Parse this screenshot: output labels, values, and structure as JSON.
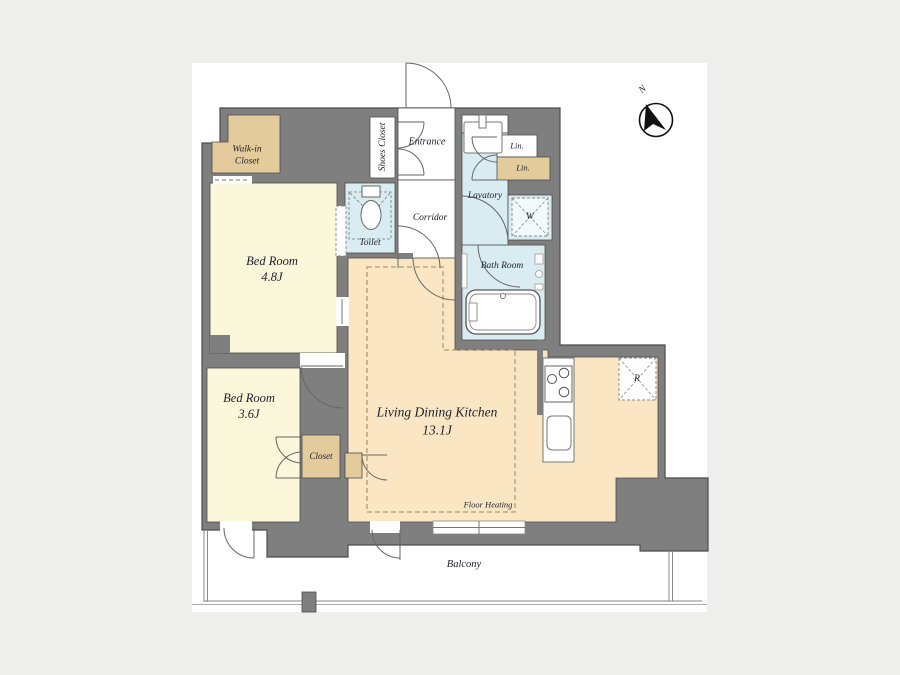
{
  "plan": {
    "type": "apartment-floor-plan",
    "layout_label": "2LDK"
  },
  "rooms": {
    "bedroom1": {
      "name": "Bed Room",
      "size": "4.8J"
    },
    "bedroom2": {
      "name": "Bed Room",
      "size": "3.6J"
    },
    "ldk": {
      "name": "Living Dining Kitchen",
      "size": "13.1J"
    },
    "walk_in_closet": {
      "line1": "Walk-in",
      "line2": "Closet"
    },
    "shoes_closet": {
      "name": "Shoes Closet"
    },
    "entrance": {
      "name": "Entrance"
    },
    "corridor": {
      "name": "Corridor"
    },
    "toilet": {
      "name": "Toilet"
    },
    "lavatory": {
      "name": "Lavatory"
    },
    "bath_room": {
      "name": "Bath Room"
    },
    "closet": {
      "name": "Closet"
    },
    "linen_upper": {
      "name": "Lin."
    },
    "linen_lower": {
      "name": "Lin."
    },
    "washer": {
      "symbol": "W"
    },
    "refrigerator": {
      "symbol": "R"
    },
    "floor_heating": {
      "name": "Floor Heating"
    },
    "balcony": {
      "name": "Balcony"
    }
  },
  "compass": {
    "north": "N"
  },
  "colors": {
    "background": "#eeeeec",
    "page": "#ffffff",
    "wall": "#7f7f7f",
    "wall_line": "#4c4c4c",
    "bedroom_cream": "#faf7da",
    "closet_tan": "#e3cb9c",
    "ldk_peach": "#fbe6c3",
    "wet_blue": "#d8ecf2",
    "heating_dash": "#b59a6e"
  }
}
